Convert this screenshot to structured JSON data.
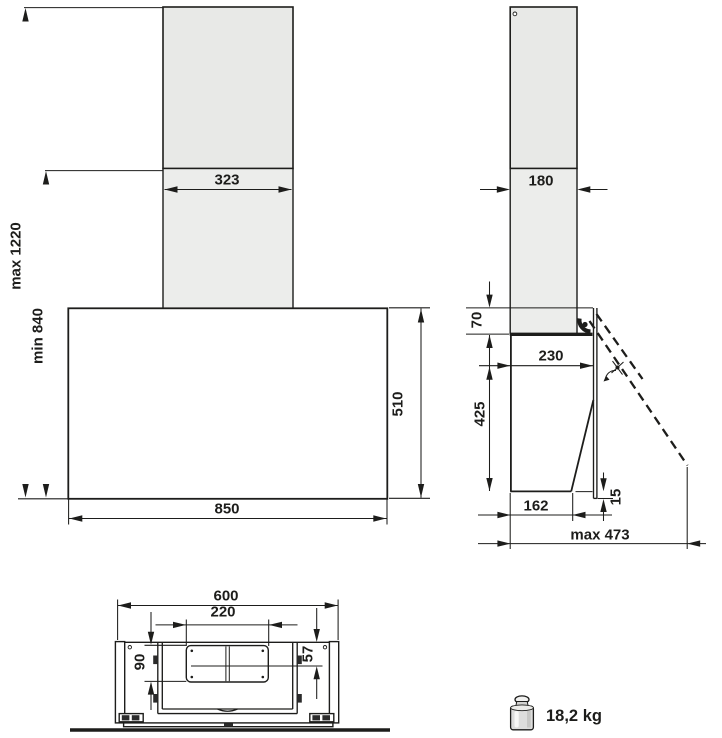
{
  "front_view": {
    "chimney_width": "323",
    "height_max": "max 1220",
    "height_min": "min 840",
    "body_height": "510",
    "body_width": "850"
  },
  "side_view": {
    "chimney_depth": "180",
    "panel_top_offset": "70",
    "top_depth": "230",
    "body_height": "425",
    "bottom_depth": "162",
    "panel_bottom_offset": "15",
    "open_depth_max": "max 473"
  },
  "bottom_view": {
    "body_width": "600",
    "outlet_width": "220",
    "outlet_depth": "90",
    "outlet_center_offset": "57"
  },
  "weight": {
    "value": "18,2 kg"
  },
  "colors": {
    "line": "#1d1d1b",
    "chimney_fill": "#e8e9e7",
    "background": "#ffffff"
  }
}
